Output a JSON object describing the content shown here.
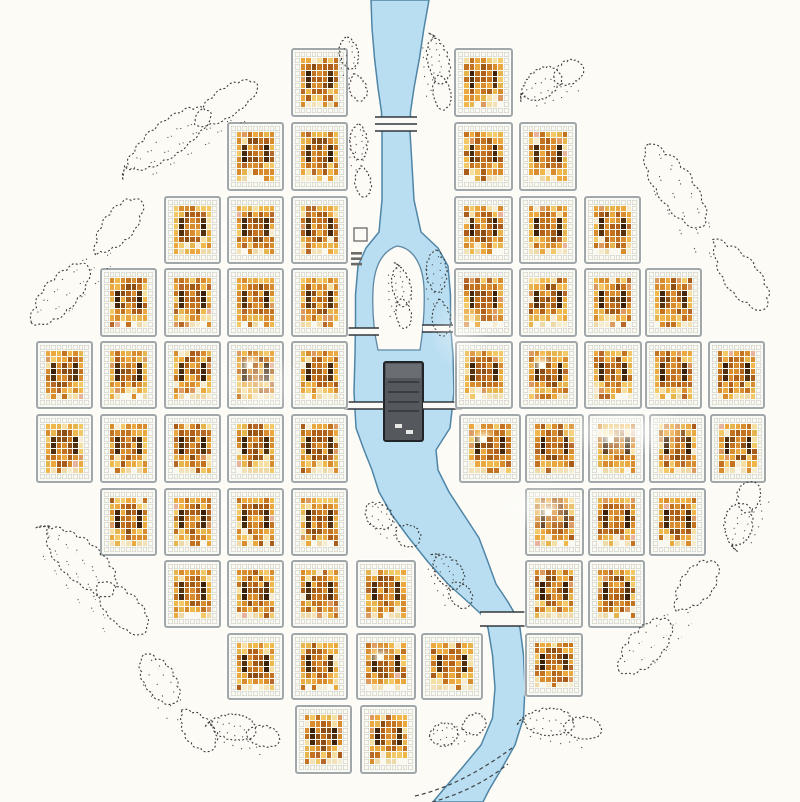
{
  "colors": {
    "background": "#fcfbf6",
    "river_fill": "#b9def1",
    "river_stroke": "#4f85a6",
    "island_fill": "#fcfbf6",
    "island_stroke": "#5e87a3",
    "block_border": "#a2a7a9",
    "block_bg": "#fafaf5",
    "grid_line": "#cfcfc6",
    "tree_stroke": "#3e3e3c",
    "fort_fill": "#55595d",
    "fort_top": "#6a6e72",
    "fort_stroke": "#212428",
    "fort_inner": "#3a3d41",
    "fort_window": "#e8e8e4",
    "bridge_line": "#33373b",
    "bridge_band": "#fbfaf6",
    "shore_line": "#3f4346",
    "symbol_stroke": "#6a6a6a"
  },
  "cell_palette": {
    "core": [
      [
        "#eaa83f",
        3
      ],
      [
        "#d98c2d",
        3
      ],
      [
        "#f3c866",
        2
      ],
      [
        "#c3731f",
        2
      ],
      [
        "#e6b54e",
        2
      ],
      [
        "#f6dfa2",
        1.2
      ],
      [
        "#aa5d1a",
        1
      ],
      [
        "#f0b84a",
        1
      ],
      [
        "#dc9a60",
        0.8
      ],
      [
        "#b5682a",
        0.8
      ],
      [
        "#f7ecd2",
        0.5
      ],
      [
        "#e7b39e",
        0.2
      ]
    ],
    "center": [
      [
        "#b06018",
        2
      ],
      [
        "#c3731f",
        2
      ],
      [
        "#d98c2d",
        2
      ],
      [
        "#8a4d16",
        1.5
      ],
      [
        "#a05a18",
        1
      ],
      [
        "#eaa83f",
        1
      ]
    ],
    "dark": [
      [
        "#46280d",
        1
      ],
      [
        "#3a2008",
        1
      ],
      [
        "#55320f",
        1
      ]
    ],
    "pale": [
      [
        "#f6ecd0",
        1
      ],
      [
        "#fbf8ef",
        1
      ],
      [
        "#eed9a8",
        1
      ],
      [
        "#f3e2b8",
        1
      ]
    ]
  },
  "map": {
    "canvas": {
      "w": 800,
      "h": 802
    },
    "seed": 7,
    "grid": {
      "cols": 9,
      "rows": 10
    },
    "blocks": [
      {
        "x": 291,
        "y": 48,
        "w": 57,
        "h": 69,
        "hi": false
      },
      {
        "x": 227,
        "y": 122,
        "w": 57,
        "h": 69,
        "hi": false
      },
      {
        "x": 291,
        "y": 122,
        "w": 57,
        "h": 69,
        "hi": false
      },
      {
        "x": 164,
        "y": 196,
        "w": 57,
        "h": 68,
        "hi": false
      },
      {
        "x": 227,
        "y": 196,
        "w": 57,
        "h": 68,
        "hi": false
      },
      {
        "x": 291,
        "y": 196,
        "w": 57,
        "h": 68,
        "hi": false
      },
      {
        "x": 100,
        "y": 268,
        "w": 57,
        "h": 69,
        "hi": false
      },
      {
        "x": 164,
        "y": 268,
        "w": 57,
        "h": 69,
        "hi": false
      },
      {
        "x": 227,
        "y": 268,
        "w": 57,
        "h": 69,
        "hi": false
      },
      {
        "x": 291,
        "y": 268,
        "w": 57,
        "h": 69,
        "hi": false
      },
      {
        "x": 36,
        "y": 341,
        "w": 57,
        "h": 68,
        "hi": false
      },
      {
        "x": 100,
        "y": 341,
        "w": 57,
        "h": 68,
        "hi": false
      },
      {
        "x": 164,
        "y": 341,
        "w": 57,
        "h": 68,
        "hi": false
      },
      {
        "x": 227,
        "y": 341,
        "w": 57,
        "h": 68,
        "hi": true
      },
      {
        "x": 291,
        "y": 341,
        "w": 57,
        "h": 68,
        "hi": false
      },
      {
        "x": 36,
        "y": 414,
        "w": 57,
        "h": 69,
        "hi": false
      },
      {
        "x": 100,
        "y": 414,
        "w": 57,
        "h": 69,
        "hi": false
      },
      {
        "x": 164,
        "y": 414,
        "w": 57,
        "h": 69,
        "hi": false
      },
      {
        "x": 227,
        "y": 414,
        "w": 57,
        "h": 69,
        "hi": false
      },
      {
        "x": 291,
        "y": 414,
        "w": 57,
        "h": 69,
        "hi": false
      },
      {
        "x": 100,
        "y": 488,
        "w": 57,
        "h": 68,
        "hi": false
      },
      {
        "x": 164,
        "y": 488,
        "w": 57,
        "h": 68,
        "hi": false
      },
      {
        "x": 227,
        "y": 488,
        "w": 57,
        "h": 68,
        "hi": false
      },
      {
        "x": 291,
        "y": 488,
        "w": 57,
        "h": 68,
        "hi": false
      },
      {
        "x": 164,
        "y": 560,
        "w": 57,
        "h": 68,
        "hi": false
      },
      {
        "x": 227,
        "y": 560,
        "w": 57,
        "h": 68,
        "hi": false
      },
      {
        "x": 291,
        "y": 560,
        "w": 57,
        "h": 68,
        "hi": false
      },
      {
        "x": 356,
        "y": 560,
        "w": 60,
        "h": 68,
        "hi": false
      },
      {
        "x": 227,
        "y": 633,
        "w": 57,
        "h": 67,
        "hi": false
      },
      {
        "x": 291,
        "y": 633,
        "w": 57,
        "h": 67,
        "hi": false
      },
      {
        "x": 356,
        "y": 633,
        "w": 60,
        "h": 67,
        "hi": true
      },
      {
        "x": 421,
        "y": 633,
        "w": 62,
        "h": 67,
        "hi": false
      },
      {
        "x": 295,
        "y": 705,
        "w": 57,
        "h": 69,
        "hi": false
      },
      {
        "x": 360,
        "y": 705,
        "w": 57,
        "h": 69,
        "hi": false
      },
      {
        "x": 454,
        "y": 48,
        "w": 59,
        "h": 69,
        "hi": false
      },
      {
        "x": 454,
        "y": 122,
        "w": 59,
        "h": 69,
        "hi": false
      },
      {
        "x": 519,
        "y": 122,
        "w": 58,
        "h": 69,
        "hi": false
      },
      {
        "x": 454,
        "y": 196,
        "w": 59,
        "h": 68,
        "hi": false
      },
      {
        "x": 519,
        "y": 196,
        "w": 58,
        "h": 68,
        "hi": false
      },
      {
        "x": 584,
        "y": 196,
        "w": 57,
        "h": 68,
        "hi": false
      },
      {
        "x": 454,
        "y": 268,
        "w": 59,
        "h": 69,
        "hi": false
      },
      {
        "x": 519,
        "y": 268,
        "w": 58,
        "h": 69,
        "hi": false
      },
      {
        "x": 584,
        "y": 268,
        "w": 57,
        "h": 69,
        "hi": false
      },
      {
        "x": 645,
        "y": 268,
        "w": 57,
        "h": 69,
        "hi": false
      },
      {
        "x": 455,
        "y": 341,
        "w": 58,
        "h": 68,
        "hi": false
      },
      {
        "x": 519,
        "y": 341,
        "w": 59,
        "h": 68,
        "hi": true
      },
      {
        "x": 584,
        "y": 341,
        "w": 58,
        "h": 68,
        "hi": false
      },
      {
        "x": 645,
        "y": 341,
        "w": 57,
        "h": 68,
        "hi": false
      },
      {
        "x": 708,
        "y": 341,
        "w": 57,
        "h": 68,
        "hi": false
      },
      {
        "x": 459,
        "y": 414,
        "w": 62,
        "h": 69,
        "hi": true
      },
      {
        "x": 525,
        "y": 414,
        "w": 59,
        "h": 69,
        "hi": false
      },
      {
        "x": 588,
        "y": 414,
        "w": 57,
        "h": 69,
        "hi": true
      },
      {
        "x": 649,
        "y": 414,
        "w": 57,
        "h": 69,
        "hi": false
      },
      {
        "x": 710,
        "y": 414,
        "w": 56,
        "h": 69,
        "hi": false
      },
      {
        "x": 525,
        "y": 488,
        "w": 59,
        "h": 68,
        "hi": true
      },
      {
        "x": 588,
        "y": 488,
        "w": 57,
        "h": 68,
        "hi": false
      },
      {
        "x": 649,
        "y": 488,
        "w": 57,
        "h": 68,
        "hi": false
      },
      {
        "x": 525,
        "y": 560,
        "w": 58,
        "h": 68,
        "hi": false
      },
      {
        "x": 588,
        "y": 560,
        "w": 57,
        "h": 68,
        "hi": false
      },
      {
        "x": 525,
        "y": 633,
        "w": 58,
        "h": 64,
        "hi": false
      }
    ],
    "river": {
      "points": [
        [
          0,
          400,
          58
        ],
        [
          28,
          398,
          52
        ],
        [
          58,
          397,
          45
        ],
        [
          88,
          396,
          36
        ],
        [
          112,
          396,
          29
        ],
        [
          132,
          396,
          28
        ],
        [
          165,
          397,
          30
        ],
        [
          200,
          398,
          32
        ],
        [
          232,
          400,
          42
        ],
        [
          248,
          402,
          72
        ],
        [
          266,
          403,
          90
        ],
        [
          295,
          403,
          95
        ],
        [
          325,
          403,
          95
        ],
        [
          355,
          404,
          98
        ],
        [
          392,
          404,
          100
        ],
        [
          428,
          403,
          94
        ],
        [
          450,
          400,
          72
        ],
        [
          470,
          405,
          66
        ],
        [
          492,
          414,
          70
        ],
        [
          515,
          428,
          72
        ],
        [
          538,
          444,
          70
        ],
        [
          562,
          458,
          60
        ],
        [
          584,
          472,
          48
        ],
        [
          602,
          488,
          40
        ],
        [
          614,
          498,
          34
        ],
        [
          628,
          504,
          32
        ],
        [
          655,
          508,
          31
        ],
        [
          688,
          510,
          30
        ],
        [
          718,
          508,
          31
        ],
        [
          745,
          498,
          34
        ],
        [
          768,
          482,
          40
        ],
        [
          790,
          466,
          46
        ],
        [
          802,
          458,
          50
        ]
      ],
      "shore_lines": [
        "M415,796 C450,788 482,770 512,748",
        "M432,802 C462,794 488,780 508,764"
      ]
    },
    "island": {
      "path": "M397,246 C380,252 374,270 373,290 C372,312 374,332 378,350 L420,350 C423,331 425,310 424,288 C423,266 414,248 397,246 Z"
    },
    "fort": {
      "x": 384,
      "y": 362,
      "w": 39,
      "h": 79,
      "top_strip_h": 14,
      "inner_lines": [
        382,
        392,
        402,
        411
      ],
      "windows": [
        [
          395,
          424,
          7,
          4
        ],
        [
          406,
          430,
          7,
          4
        ]
      ]
    },
    "bridges": [
      {
        "x1": 375,
        "x2": 417,
        "lines": [
          117,
          124,
          131
        ]
      },
      {
        "x1": 348,
        "x2": 379,
        "lines": [
          328,
          335
        ]
      },
      {
        "x1": 422,
        "x2": 453,
        "lines": [
          325,
          332
        ]
      },
      {
        "x1": 344,
        "x2": 384,
        "lines": [
          402,
          409
        ]
      },
      {
        "x1": 422,
        "x2": 462,
        "lines": [
          402,
          409
        ]
      },
      {
        "x1": 480,
        "x2": 526,
        "lines": [
          612,
          626
        ]
      }
    ],
    "symbols": {
      "square": {
        "x": 354,
        "y": 228,
        "s": 13
      },
      "bars": {
        "x": 351,
        "y": 252,
        "w": 11,
        "h": 2.6,
        "gap": 5.4,
        "count": 3
      }
    },
    "trees": [
      [
        190,
        130,
        185,
        48,
        -33
      ],
      [
        84,
        268,
        175,
        50,
        -48
      ],
      [
        92,
        580,
        170,
        55,
        47
      ],
      [
        174,
        700,
        125,
        46,
        55
      ],
      [
        243,
        733,
        85,
        36,
        15
      ],
      [
        456,
        731,
        62,
        34,
        -15
      ],
      [
        560,
        727,
        95,
        38,
        8
      ],
      [
        666,
        623,
        155,
        52,
        -48
      ],
      [
        745,
        516,
        80,
        40,
        -72
      ],
      [
        700,
        222,
        215,
        56,
        55
      ],
      [
        552,
        83,
        80,
        40,
        -25
      ],
      [
        352,
        67,
        70,
        28,
        78
      ],
      [
        437,
        72,
        88,
        30,
        82
      ],
      [
        360,
        158,
        78,
        26,
        86
      ],
      [
        400,
        296,
        75,
        26,
        84
      ],
      [
        390,
        524,
        68,
        36,
        38
      ],
      [
        450,
        581,
        72,
        36,
        60
      ],
      [
        438,
        290,
        92,
        30,
        86
      ]
    ],
    "glare": [
      {
        "x": 555,
        "y": 405,
        "w": 140,
        "h": 52,
        "o": 0.75
      },
      {
        "x": 495,
        "y": 478,
        "w": 95,
        "h": 55,
        "o": 0.5
      },
      {
        "x": 222,
        "y": 352,
        "w": 80,
        "h": 62,
        "o": 0.55
      },
      {
        "x": 430,
        "y": 298,
        "w": 60,
        "h": 72,
        "o": 0.4
      }
    ]
  }
}
